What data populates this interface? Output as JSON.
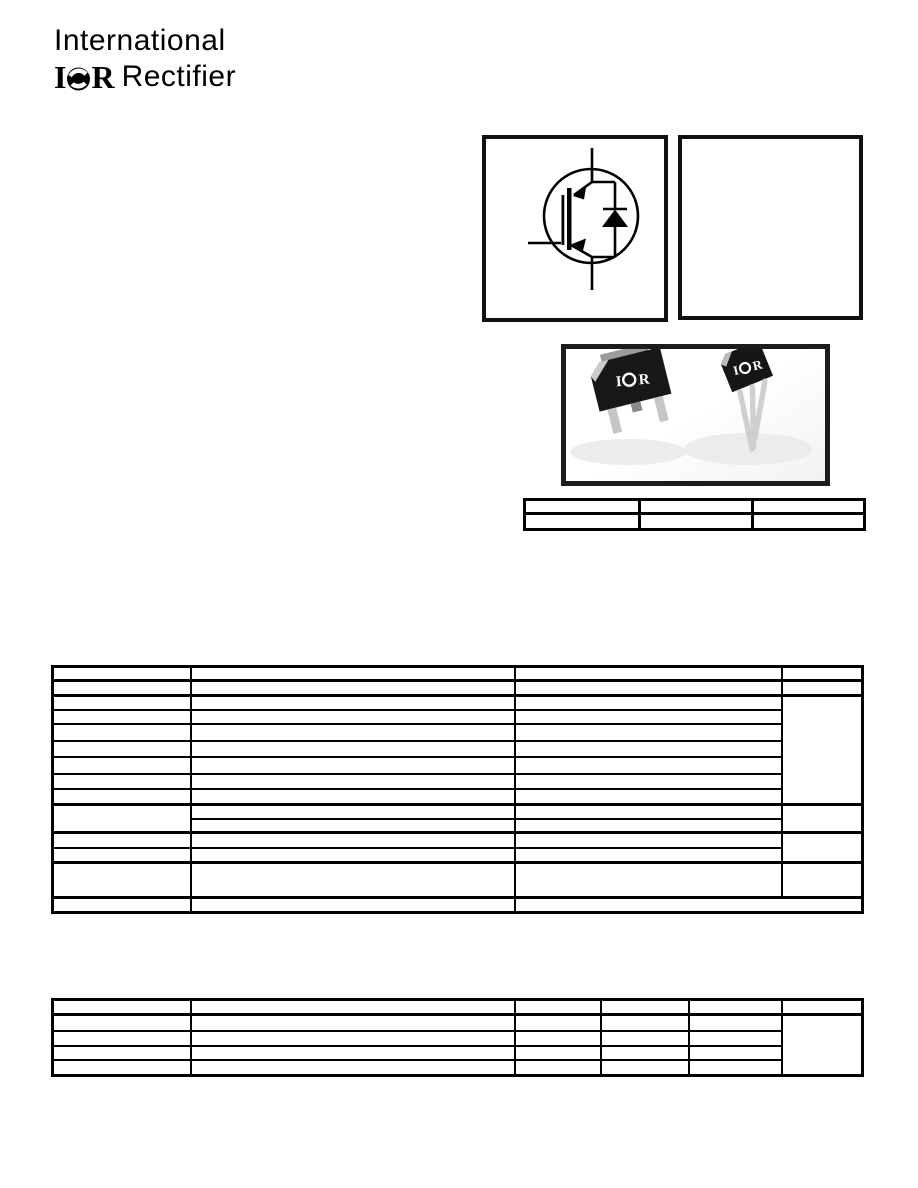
{
  "page": {
    "background": "#ffffff",
    "ink": "#000000"
  },
  "logo": {
    "line1": "International",
    "brand_i": "I",
    "brand_r": "R",
    "line2": "Rectifier"
  },
  "symbol_box": {
    "icon": "igbt-with-antiparallel-diode-symbol"
  },
  "package_photo": {
    "logo_i": "I",
    "logo_r": "R",
    "body_color": "#1a1a1a",
    "bevel_color": "#cccccc",
    "lead_color": "#c6c6c6",
    "shadow_color": "#ececec",
    "border_color": "#1c1c1c"
  },
  "tables": {
    "part_table": {
      "cols": 3,
      "rows": 2,
      "cells": [
        [
          "",
          "",
          ""
        ],
        [
          "",
          "",
          ""
        ]
      ]
    },
    "ratings_table": {
      "cols": 4,
      "rows": 15,
      "all_cells_blank": true
    },
    "thermal_table": {
      "cols": 6,
      "rows": 5,
      "all_cells_blank": true
    }
  }
}
